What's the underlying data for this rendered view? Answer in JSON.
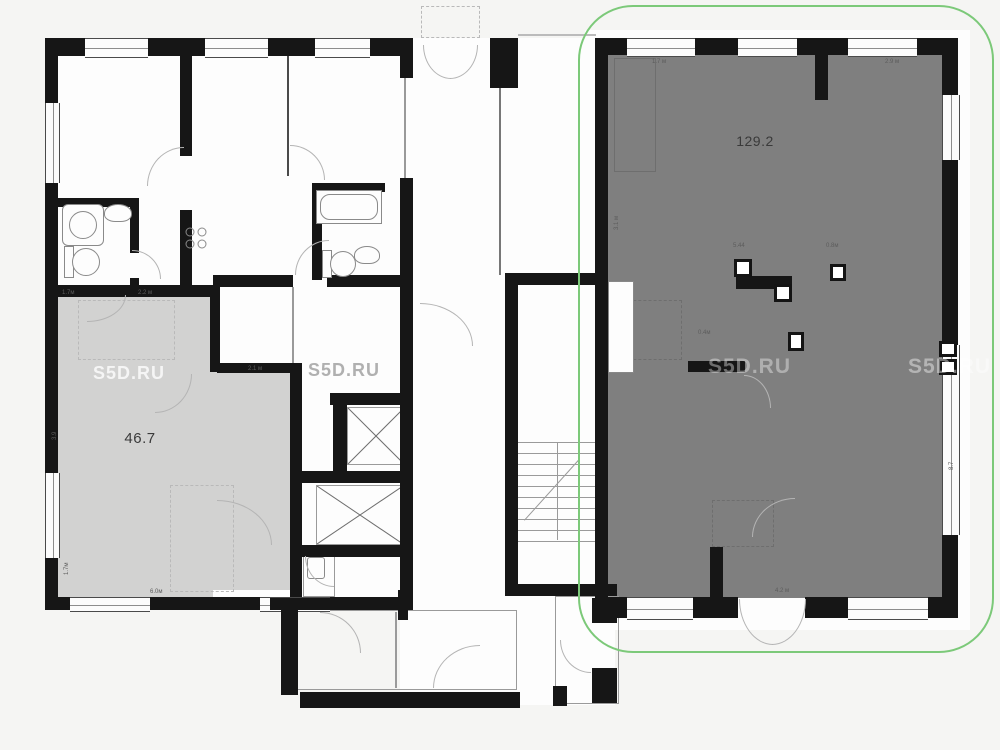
{
  "plan": {
    "title": "floor-plan",
    "highlight_color": "#7cc979",
    "wall_color": "#161616",
    "rooms": [
      {
        "id": "room-46-7",
        "area_label": "46.7",
        "fill": "#d2d2d1"
      },
      {
        "id": "room-129-2",
        "area_label": "129.2",
        "fill": "#7f7f7f",
        "highlighted": true
      }
    ],
    "watermarks": [
      "S5D.RU",
      "S5D.RU",
      "S5D.RU",
      "S5D.RU"
    ],
    "dimension_labels": [
      "1.7 м",
      "2.9 м",
      "5.44",
      "0.8м",
      "3.1 м",
      "8.7",
      "2.1 м",
      "2.2 м",
      "1.7м",
      "6.0м",
      "1.7м",
      "4.2 м",
      "0.4м",
      "3.9"
    ]
  }
}
